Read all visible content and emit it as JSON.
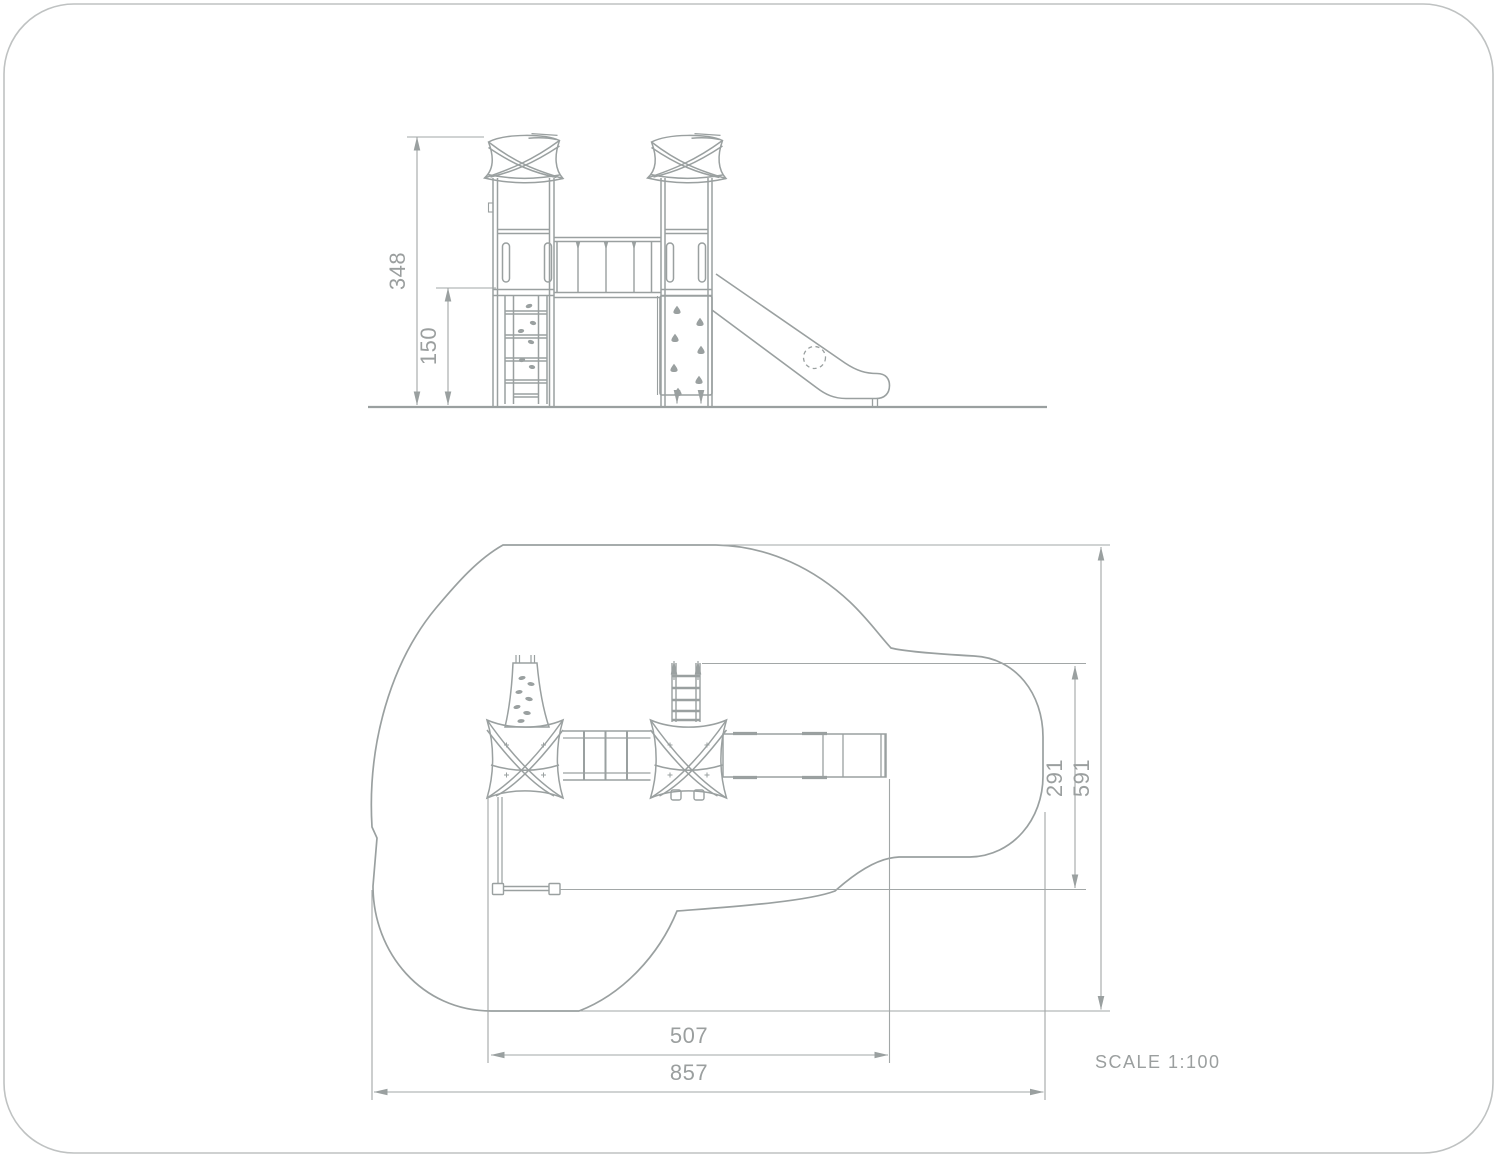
{
  "drawing": {
    "scale_label": "SCALE 1:100",
    "elevation": {
      "dims": {
        "total_height": "348",
        "platform_height": "150"
      }
    },
    "plan": {
      "dims": {
        "inner_depth": "291",
        "total_depth": "591",
        "inner_width": "507",
        "total_width": "857"
      }
    }
  },
  "colors": {
    "line": "#9aa0a0",
    "dimension_line": "#a2a7a7",
    "dimension_text": "#9b9f9f",
    "border": "#bfc2c2",
    "background": "#ffffff"
  }
}
